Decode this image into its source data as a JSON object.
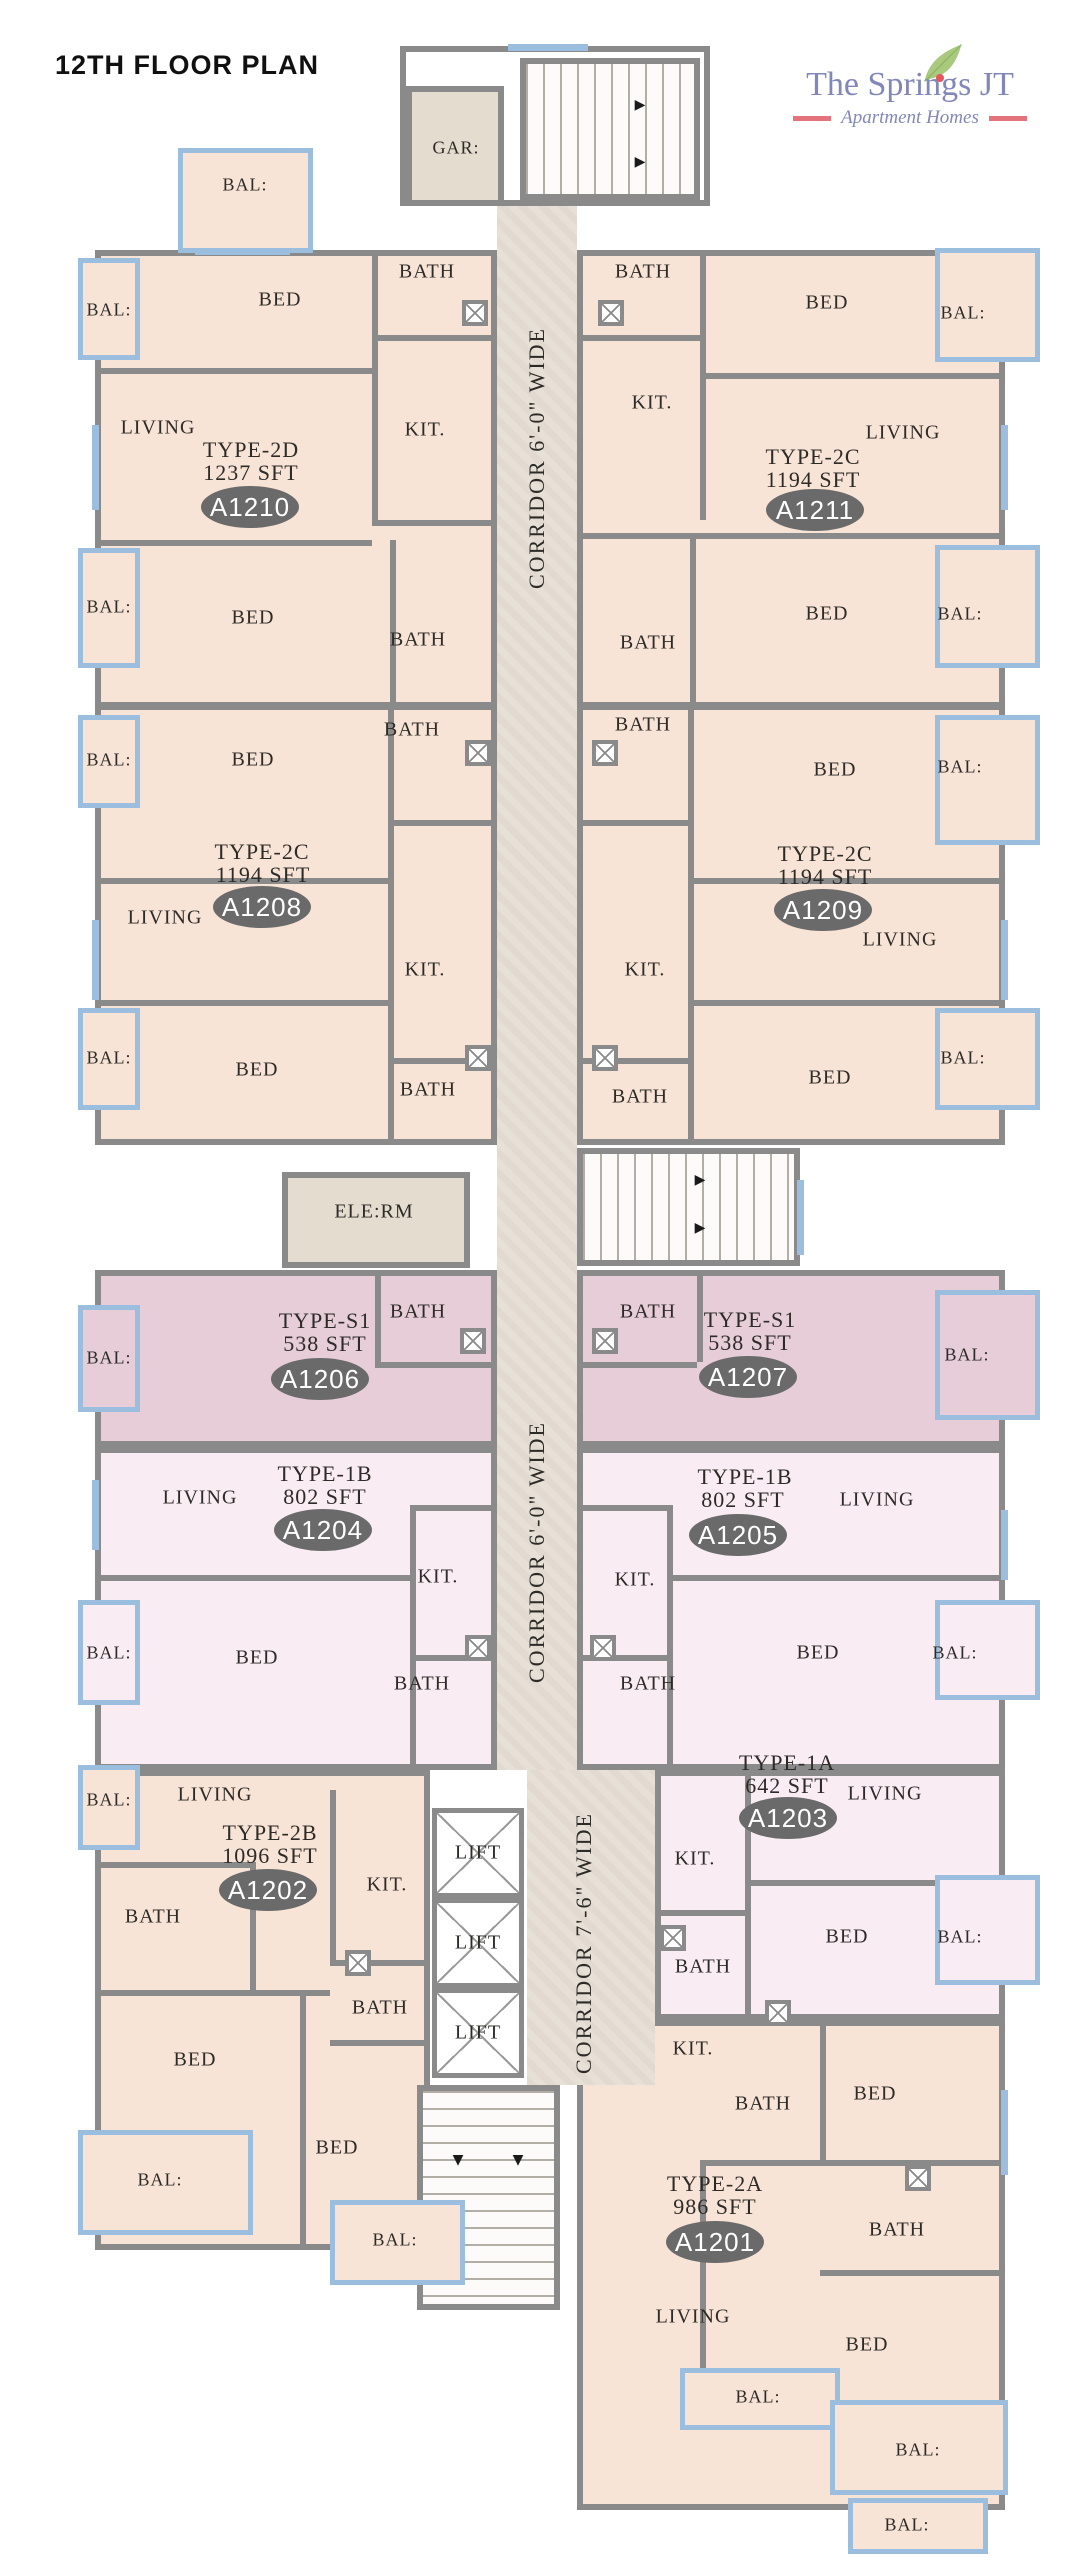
{
  "header": {
    "title": "12TH FLOOR PLAN"
  },
  "logo": {
    "brand": "The Springs JT",
    "tagline": "Apartment Homes"
  },
  "corridors": {
    "top": "CORRIDOR 6'-0\" WIDE",
    "middle": "CORRIDOR 6'-0\" WIDE",
    "bottom": "CORRIDOR 7'-6\" WIDE"
  },
  "rooms": {
    "bed": "BED",
    "bath": "BATH",
    "kitchen": "KIT.",
    "living": "LIVING",
    "balcony": "BAL:",
    "garage": "GAR:",
    "elevator_room": "ELE:RM",
    "lift": "LIFT"
  },
  "icons": {
    "stair_arrow_right": "▶",
    "stair_arrow_down": "▼"
  },
  "units": [
    {
      "number": "A1210",
      "type": "TYPE-2D",
      "area": "1237 SFT"
    },
    {
      "number": "A1211",
      "type": "TYPE-2C",
      "area": "1194 SFT"
    },
    {
      "number": "A1208",
      "type": "TYPE-2C",
      "area": "1194 SFT"
    },
    {
      "number": "A1209",
      "type": "TYPE-2C",
      "area": "1194 SFT"
    },
    {
      "number": "A1206",
      "type": "TYPE-S1",
      "area": "538 SFT"
    },
    {
      "number": "A1207",
      "type": "TYPE-S1",
      "area": "538 SFT"
    },
    {
      "number": "A1204",
      "type": "TYPE-1B",
      "area": "802 SFT"
    },
    {
      "number": "A1205",
      "type": "TYPE-1B",
      "area": "802 SFT"
    },
    {
      "number": "A1202",
      "type": "TYPE-2B",
      "area": "1096 SFT"
    },
    {
      "number": "A1203",
      "type": "TYPE-1A",
      "area": "642 SFT"
    },
    {
      "number": "A1201",
      "type": "TYPE-2A",
      "area": "986 SFT"
    }
  ],
  "colors": {
    "wall": "#8a8a8a",
    "unit_peach": "#f8e4d6",
    "unit_mauve": "#e6cdd8",
    "unit_pink": "#f9edf3",
    "corridor": "#e7e0d6",
    "balcony_blue": "#9cbede",
    "badge": "#6a6a6a",
    "brand_text": "#8287b9",
    "brand_accent": "#e4737c",
    "leaf_green": "#a9c97e"
  }
}
